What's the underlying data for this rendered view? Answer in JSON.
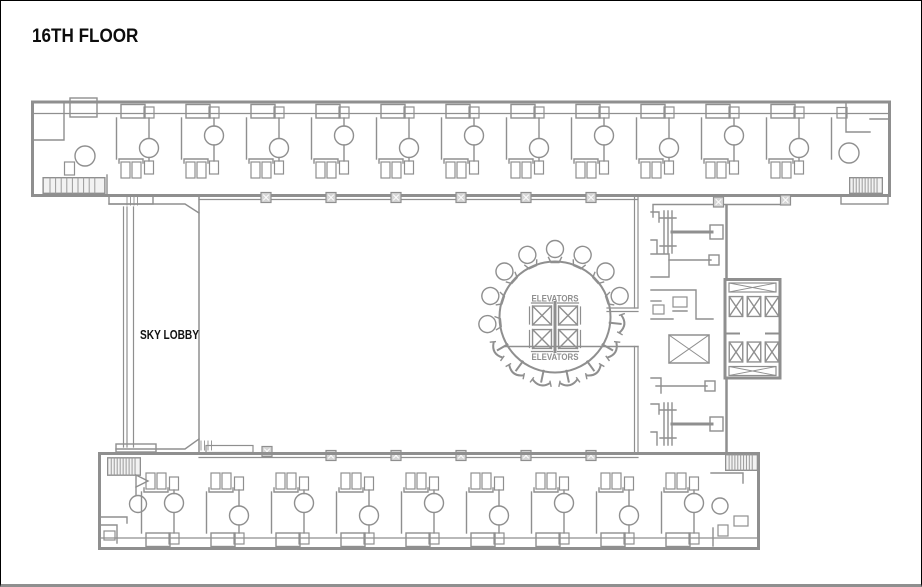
{
  "header": {
    "title": "16TH FLOOR"
  },
  "plan": {
    "sky_lobby_label": "SKY LOBBY",
    "elevators_label_top": "ELEVATORS",
    "elevators_label_bottom": "ELEVATORS"
  },
  "colors": {
    "wall_gray": "#8f8f8f",
    "label_black": "#121212",
    "column_fill": "#d6d6d6",
    "frame_border": "#000000",
    "frame_bottom_border": "#8f8f8f",
    "background": "#ffffff"
  },
  "symbols": {
    "elevator_shaft": "crossed-square",
    "mechanical_shaft": "crossed-rect",
    "stairwell": "hatched-rect",
    "structural_column": "filled-square-with-x",
    "lounge_chair_round": "balloon-chair",
    "lounge_chair_side": "t-chair",
    "room_fixture": "circle-on-partition"
  }
}
